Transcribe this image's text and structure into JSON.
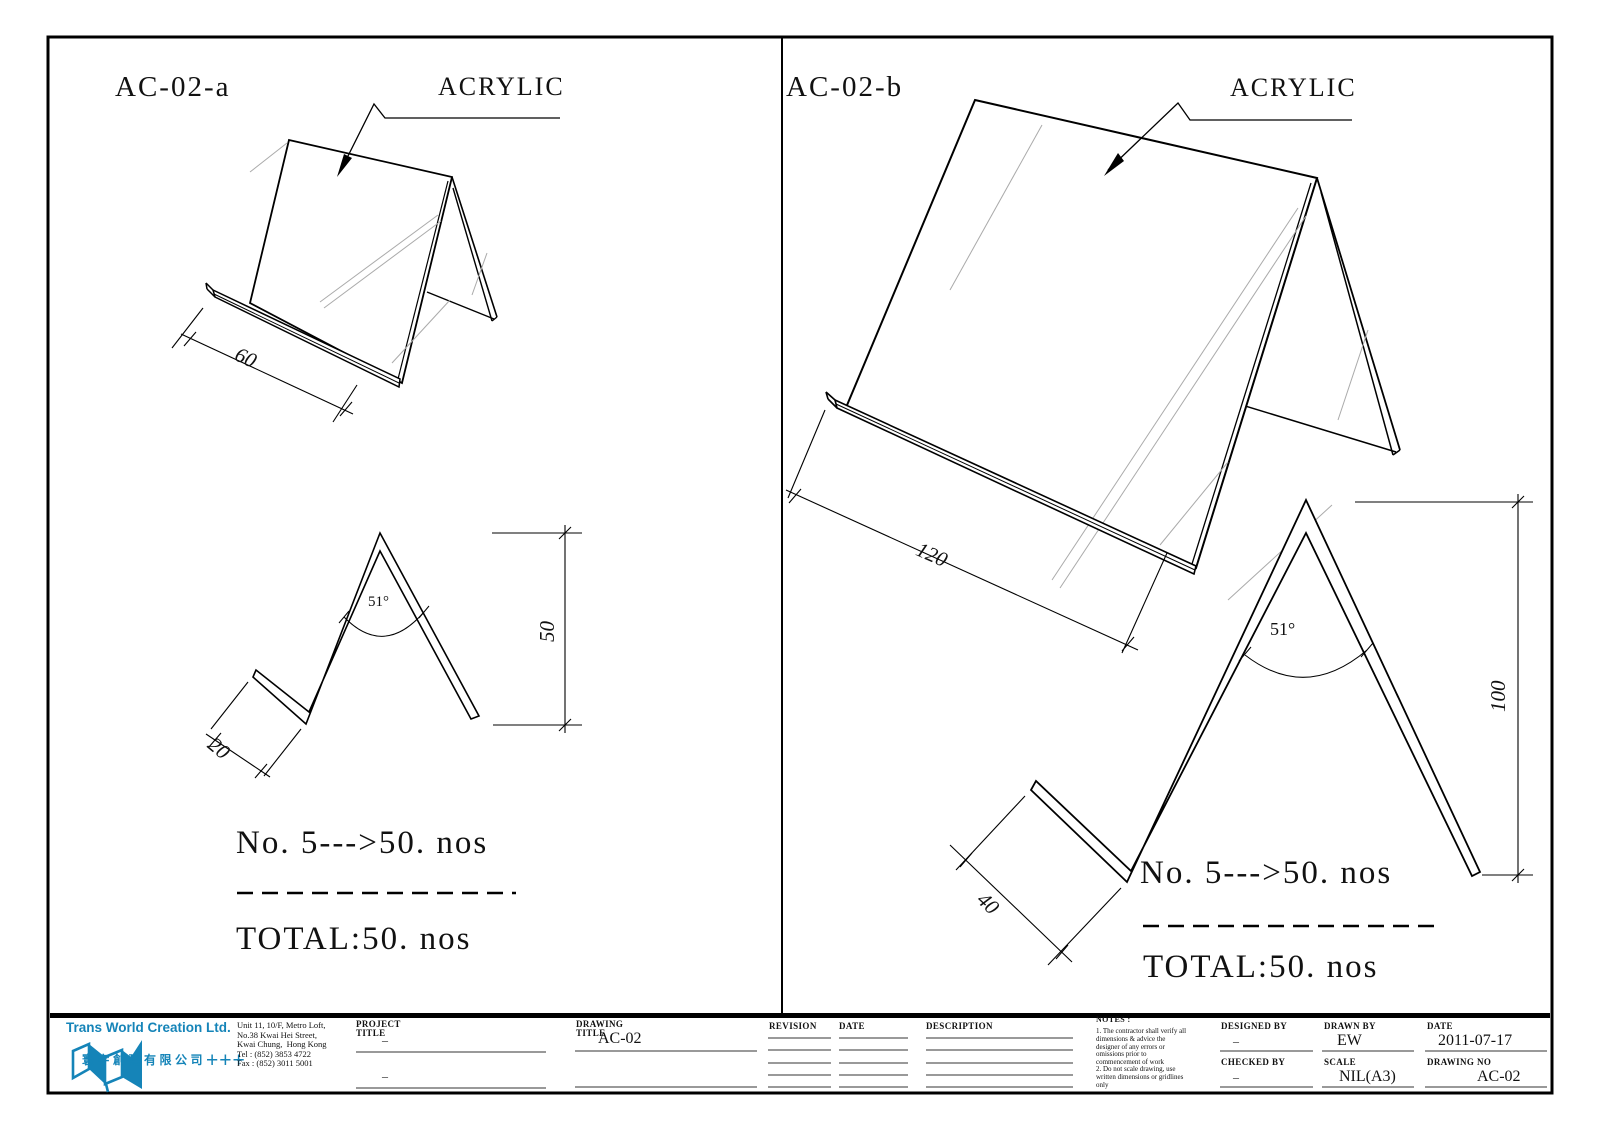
{
  "accent_color": "#1584b8",
  "panels": {
    "left": {
      "label": "AC-02-a",
      "material_label": "ACRYLIC",
      "dims": {
        "width": "60",
        "lip": "20",
        "height": "50",
        "angle": "51°"
      },
      "qty_line": "No. 5--->50. nos",
      "total_line": "TOTAL:50. nos"
    },
    "right": {
      "label": "AC-02-b",
      "material_label": "ACRYLIC",
      "dims": {
        "width": "120",
        "lip": "40",
        "height": "100",
        "angle": "51°"
      },
      "qty_line": "No. 5--->50. nos",
      "total_line": "TOTAL:50. nos"
    }
  },
  "title_block": {
    "company": {
      "name": "Trans World Creation Ltd.",
      "name_cn": "寰宇創建有限公司",
      "marks": "+++",
      "address_lines": "Unit 11, 10/F, Metro Loft,\nNo.38 Kwai Hei Street,\nKwai Chung,  Hong Kong\nTel : (852) 3853 4722\nFax : (852) 3011 5001"
    },
    "project_title": {
      "label": "PROJECT\nTITLE",
      "value1": "–",
      "value2": "–"
    },
    "drawing_title": {
      "label": "DRAWING\nTITLE",
      "value": "AC-02"
    },
    "revision": {
      "label": "REVISION"
    },
    "date_col": {
      "label": "DATE"
    },
    "description": {
      "label": "DESCRIPTION"
    },
    "notes": {
      "label": "NOTES :",
      "items": [
        "1. The contractor shall verify all dimensions & advice the designer of any errors or omissions prior to commencement of work",
        "2. Do not scale drawing, use written dimensions or gridlines only"
      ]
    },
    "designed_by": {
      "label": "DESIGNED BY",
      "value": "–"
    },
    "checked_by": {
      "label": "CHECKED BY",
      "value": "–"
    },
    "drawn_by": {
      "label": "DRAWN BY",
      "value": "EW"
    },
    "scale": {
      "label": "SCALE",
      "value": "NIL(A3)"
    },
    "date": {
      "label": "DATE",
      "value": "2011-07-17"
    },
    "drawing_no": {
      "label": "DRAWING NO",
      "value": "AC-02"
    }
  }
}
